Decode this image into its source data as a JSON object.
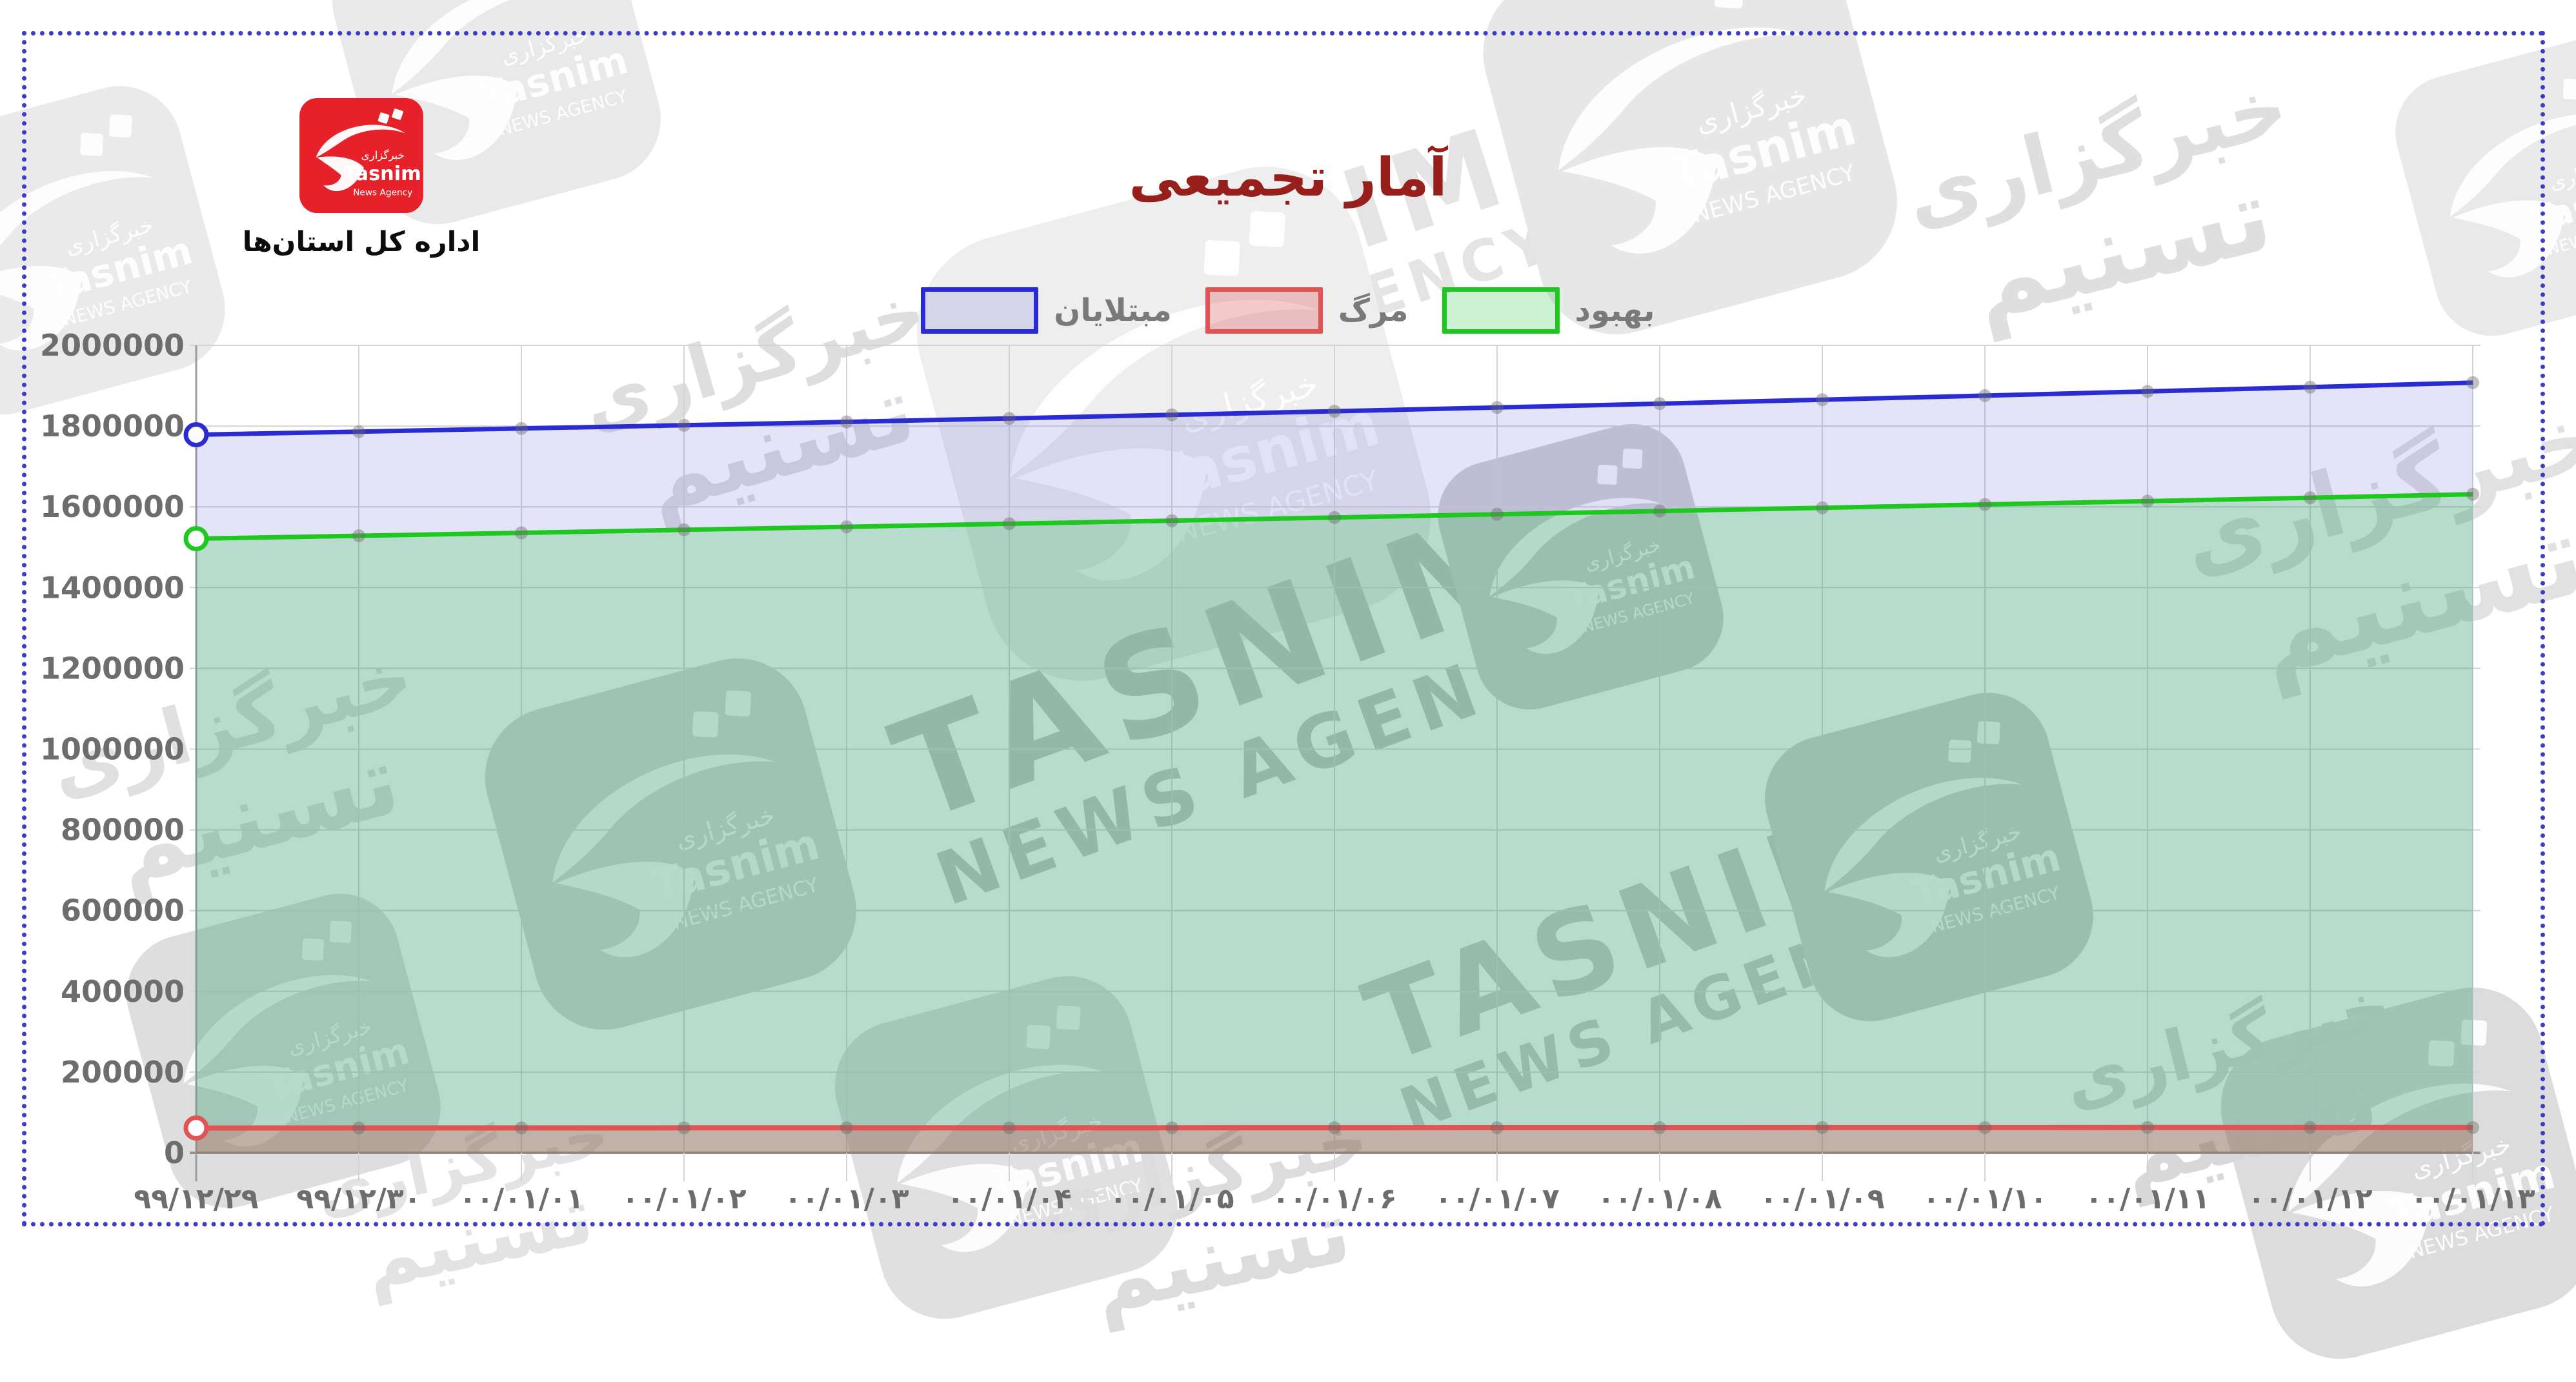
{
  "frame": {
    "color": "#3c3cc9"
  },
  "branding": {
    "logo": {
      "agency_fa": "خبرگزاری",
      "agency_en": "Tasnim",
      "agency_sub": "News Agency",
      "bg_color": "#e62129"
    },
    "department": "اداره کل استان‌ها"
  },
  "watermark": {
    "en_line1": "TASNIM",
    "en_line2": "NEWS AGENCY",
    "fa_line1": "خبرگزاری",
    "fa_line2": "تسنیم"
  },
  "chart_data": {
    "type": "area",
    "title": "آمار تجمیعی",
    "title_color": "#97201d",
    "categories": [
      "۹۹/۱۲/۲۹",
      "۹۹/۱۲/۳۰",
      "۰۰/۰۱/۰۱",
      "۰۰/۰۱/۰۲",
      "۰۰/۰۱/۰۳",
      "۰۰/۰۱/۰۴",
      "۰۰/۰۱/۰۵",
      "۰۰/۰۱/۰۶",
      "۰۰/۰۱/۰۷",
      "۰۰/۰۱/۰۸",
      "۰۰/۰۱/۰۹",
      "۰۰/۰۱/۱۰",
      "۰۰/۰۱/۱۱",
      "۰۰/۰۱/۱۲",
      "۰۰/۰۱/۱۳"
    ],
    "series": [
      {
        "id": "cases",
        "name": "مبتلایان",
        "color": "#2b2bd4",
        "fill": "rgba(85,85,218,0.16)",
        "values": [
          1778645,
          1786245,
          1794045,
          1802145,
          1810445,
          1818945,
          1827745,
          1836745,
          1846045,
          1855545,
          1865345,
          1875445,
          1885845,
          1896545,
          1907545
        ]
      },
      {
        "id": "deaths",
        "name": "مرگ",
        "color": "#e05454",
        "fill": "rgba(222,80,80,0.30)",
        "values": [
          61581,
          61666,
          61752,
          61837,
          61925,
          62011,
          62097,
          62186,
          62274,
          62363,
          62456,
          62549,
          62646,
          62746,
          62849
        ]
      },
      {
        "id": "recovered",
        "name": "بهبود",
        "color": "#1fc81f",
        "fill": "rgba(40,195,70,0.24)",
        "values": [
          1521139,
          1528339,
          1535639,
          1543039,
          1550539,
          1558139,
          1565839,
          1573639,
          1581539,
          1589539,
          1597639,
          1605839,
          1614139,
          1622539,
          1631139
        ]
      }
    ],
    "draw_order": [
      0,
      2,
      1
    ],
    "ylim": [
      0,
      2000000
    ],
    "ytick_step": 200000,
    "ytick_labels": [
      "0",
      "200000",
      "400000",
      "600000",
      "800000",
      "1000000",
      "1200000",
      "1400000",
      "1600000",
      "1800000",
      "2000000"
    ],
    "grid": true,
    "legend_position": "top-center"
  }
}
